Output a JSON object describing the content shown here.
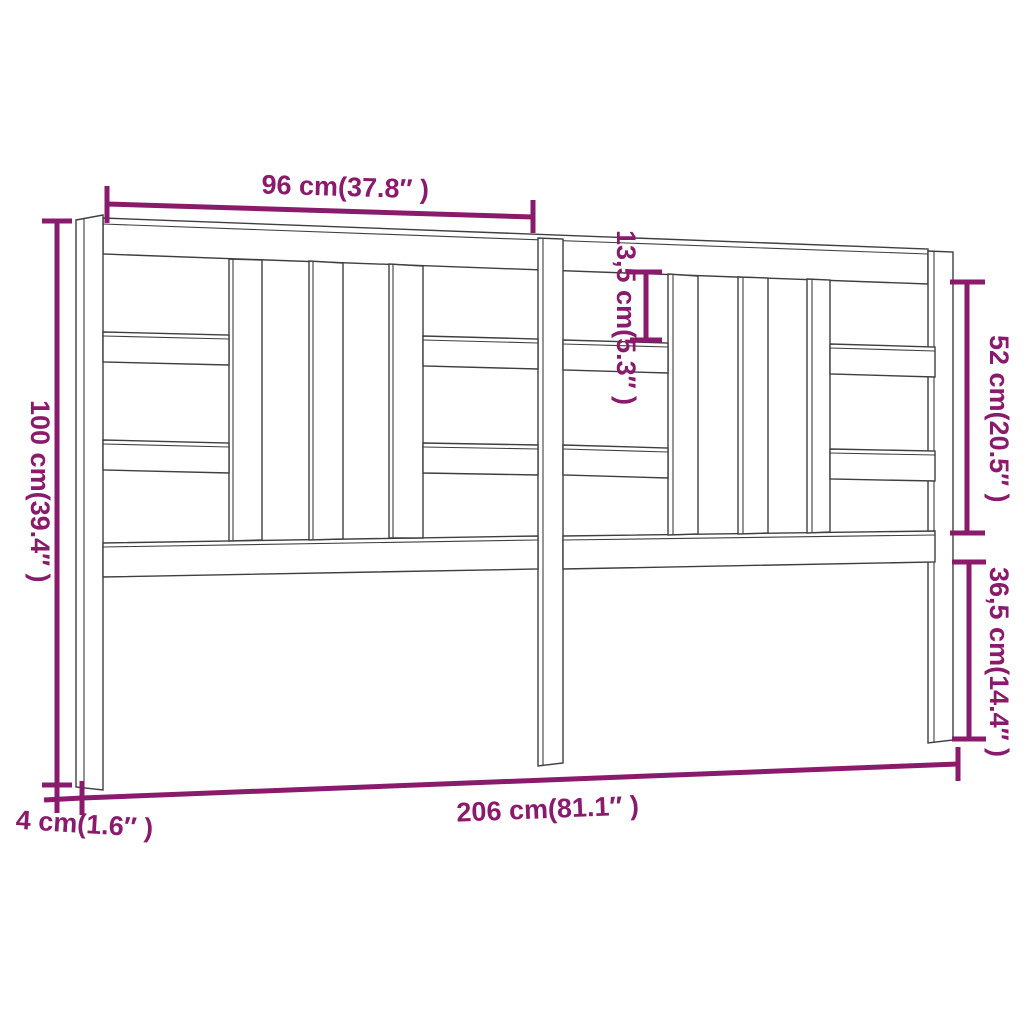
{
  "diagram": {
    "kind": "furniture dimension drawing",
    "subject": "bed headboard front view with three posts, vertical slats and horizontal boards",
    "background_color": "#ffffff",
    "line_color": "#3f3f3f",
    "dimension_color": "#8a1a6b",
    "labels": {
      "top_section_width": "96 cm(37.8″ )",
      "upper_gap_height": "13,5 cm(5.3″ )",
      "panel_opening_height": "52 cm(20.5″ )",
      "total_height": "100 cm(39.4″ )",
      "lower_post_height": "36,5 cm(14.4″ )",
      "total_width": "206 cm(81.1″ )",
      "post_thickness": "4 cm(1.6″ )"
    }
  }
}
